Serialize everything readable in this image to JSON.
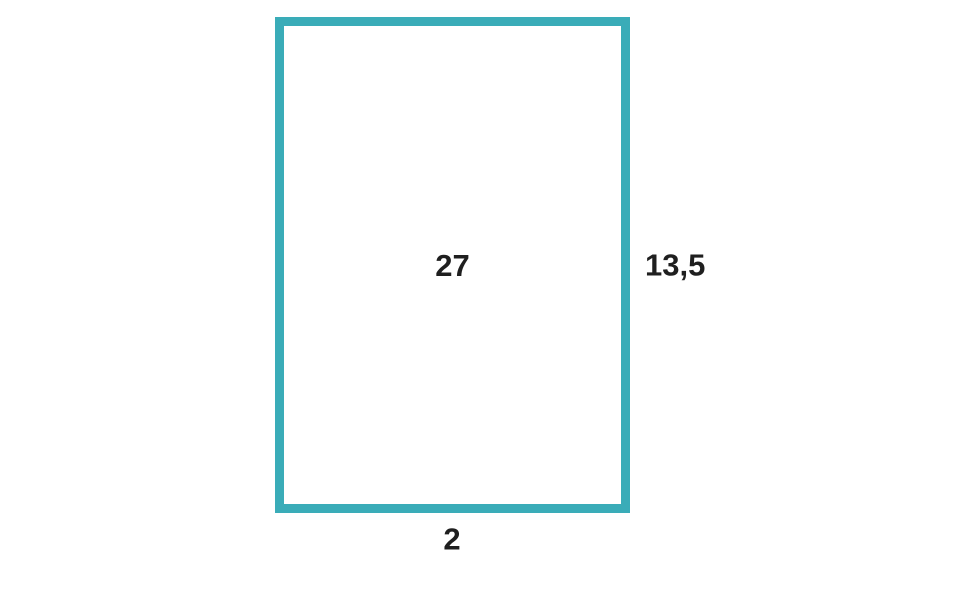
{
  "diagram": {
    "shape": "rectangle",
    "border_color": "#3aacb8",
    "background_color": "#ffffff",
    "text_color": "#1f1f1f",
    "labels": {
      "center": "27",
      "right": "13,5",
      "bottom": "2"
    }
  }
}
